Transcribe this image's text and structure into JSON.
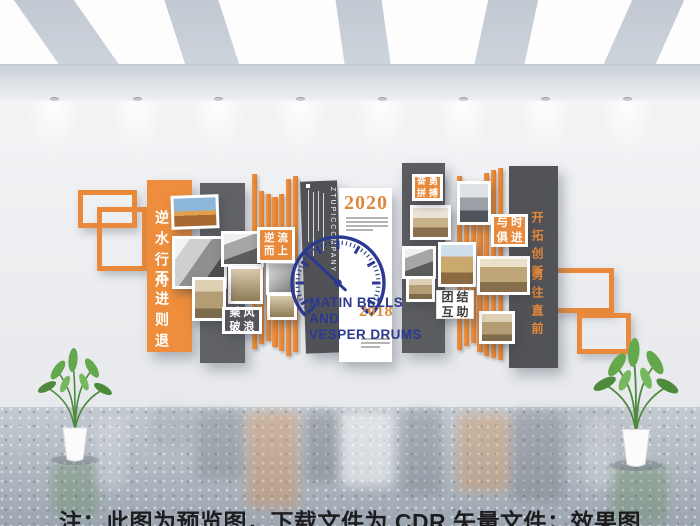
{
  "scene": {
    "caption": "注：此图为预览图，下载文件为 CDR 矢量文件；效果图",
    "colors": {
      "accent_orange": "#E8893B",
      "clock_navy": "#2B3990",
      "panel_gray": "#5B5C60",
      "year_orange": "#DC8A3E"
    }
  },
  "art": {
    "left_slogan": {
      "phrase1": "逆水行舟",
      "phrase2": "不进则退"
    },
    "right_slogan": {
      "phrase1": "开拓创新",
      "phrase2": "勇往直前"
    },
    "badges": {
      "upstream": {
        "line1": "逆流",
        "line2": "而上"
      },
      "ride_wind": {
        "line1": "乘风",
        "line2": "破浪"
      },
      "strive": {
        "line1": "奋勇",
        "line2": "拼搏"
      },
      "unity": {
        "line1": "团结",
        "line2": "互助"
      },
      "with_times": {
        "line1": "与时",
        "line2": "俱进"
      }
    },
    "center_panel": {
      "company_vertical": "ZTUPICCOMPANY",
      "year_top": "2020",
      "year_bottom": "2018",
      "clock_title_line1": "MATIN BELLS",
      "clock_title_line2": "AND",
      "clock_title_line3": "VESPER DRUMS"
    }
  }
}
